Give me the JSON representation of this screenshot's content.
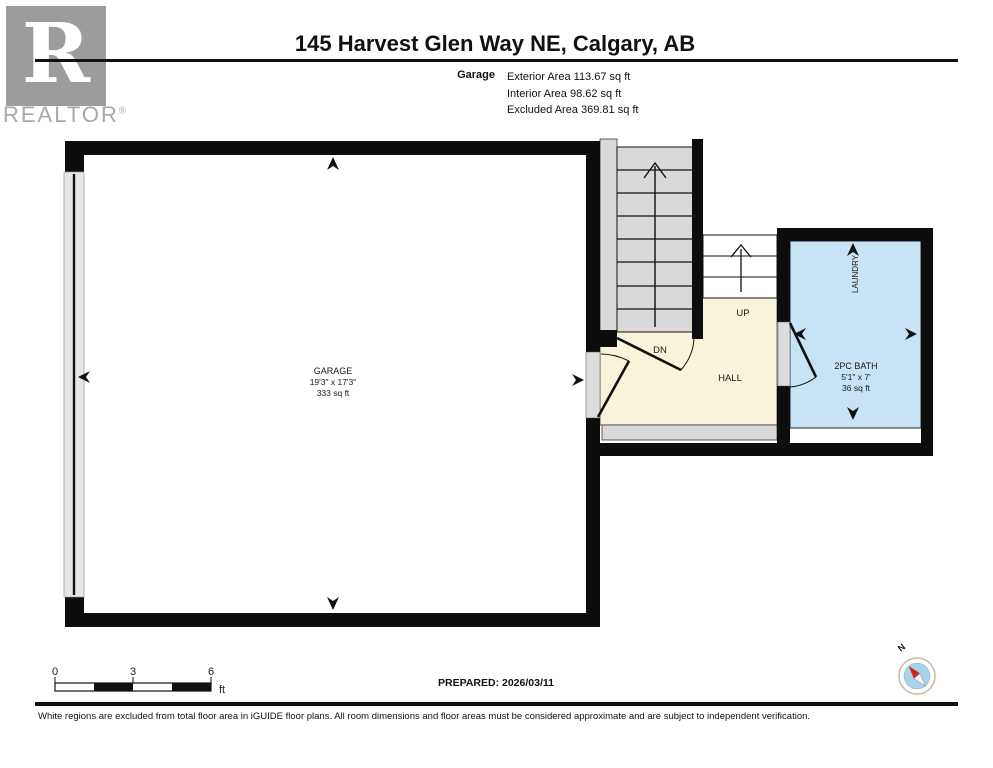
{
  "header": {
    "title": "145 Harvest Glen Way NE, Calgary, AB",
    "floor_label": "Garage",
    "area_lines": [
      "Exterior Area 113.67 sq ft",
      "Interior Area 98.62 sq ft",
      "Excluded Area 369.81 sq ft"
    ],
    "logo": {
      "letter": "R",
      "brand": "REALTOR",
      "registered": "®"
    }
  },
  "floorplan": {
    "rooms": {
      "garage": {
        "name": "GARAGE",
        "dimensions": "19'3\" x 17'3\"",
        "area": "333 sq ft"
      },
      "hall": {
        "name": "HALL"
      },
      "bath": {
        "name": "2PC BATH",
        "dimensions": "5'1\" x 7'",
        "area": "36 sq ft"
      },
      "laundry": {
        "name": "LAUNDRY"
      }
    },
    "stairs": {
      "up": "UP",
      "down": "DN"
    }
  },
  "scale_bar": {
    "ticks": [
      "0",
      "3",
      "6"
    ],
    "unit": "ft"
  },
  "prepared": "PREPARED: 2026/03/11",
  "compass": {
    "north_label": "N"
  },
  "footer_note": "White regions are excluded from total floor area in iGUIDE floor plans. All room dimensions and floor areas must be considered approximate and are subject to independent verification.",
  "colors": {
    "hall_floor": "#FAF3DC",
    "bath_floor": "#C7E3F4",
    "excluded_gray": "#D9D9D9",
    "wall_black": "#0d0d0d",
    "compass_red": "#C62B1E",
    "compass_blue": "#A9D3EA",
    "logo_gray": "#9C9C9C"
  }
}
